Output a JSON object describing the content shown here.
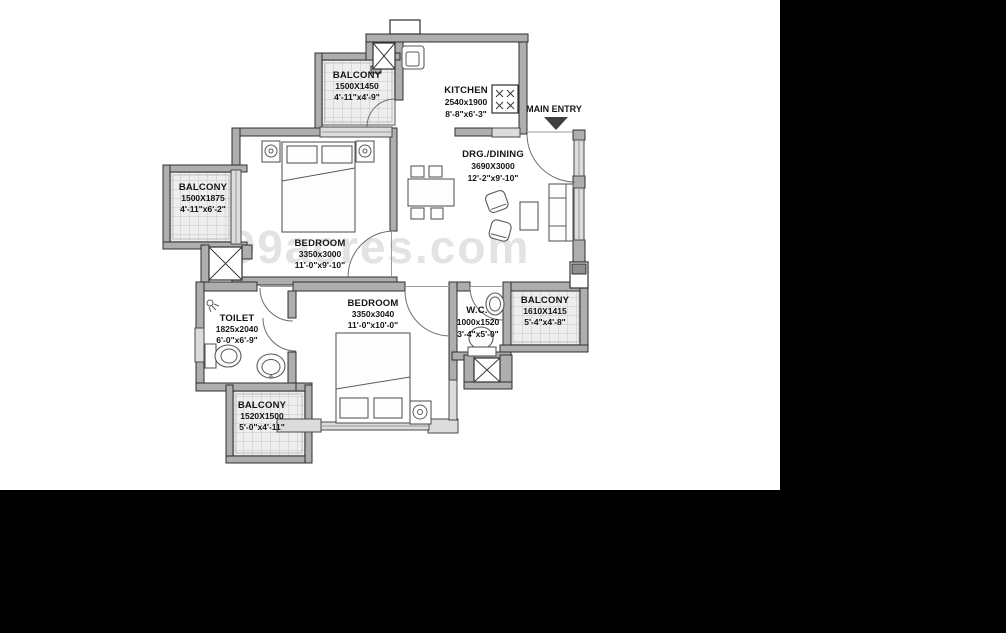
{
  "watermark": "99acres.com",
  "entry": {
    "label": "MAIN ENTRY"
  },
  "rooms": {
    "balcony_top": {
      "name": "BALCONY",
      "metric": "1500X1450",
      "imperial": "4'-11\"x4'-9\""
    },
    "kitchen": {
      "name": "KITCHEN",
      "metric": "2540x1900",
      "imperial": "8'-8\"x6'-3\""
    },
    "drg_dining": {
      "name": "DRG./DINING",
      "metric": "3690X3000",
      "imperial": "12'-2\"x9'-10\""
    },
    "balcony_left": {
      "name": "BALCONY",
      "metric": "1500X1875",
      "imperial": "4'-11\"x6'-2\""
    },
    "bedroom1": {
      "name": "BEDROOM",
      "metric": "3350x3000",
      "imperial": "11'-0\"x9'-10\""
    },
    "toilet": {
      "name": "TOILET",
      "metric": "1825x2040",
      "imperial": "6'-0\"x6'-9\""
    },
    "bedroom2": {
      "name": "BEDROOM",
      "metric": "3350x3040",
      "imperial": "11'-0\"x10'-0\""
    },
    "wc": {
      "name": "W.C.",
      "metric": "1000x1520",
      "imperial": "3'-4\"x5'-0\""
    },
    "balcony_right": {
      "name": "BALCONY",
      "metric": "1610X1415",
      "imperial": "5'-4\"x4'-8\""
    },
    "balcony_bottom": {
      "name": "BALCONY",
      "metric": "1520X1500",
      "imperial": "5'-0\"x4'-11\""
    }
  },
  "colors": {
    "background": "#000000",
    "paper": "#ffffff",
    "wall": "#aeaeae",
    "wall_outline": "#2f2f2f",
    "window": "#dcdcdc",
    "watermark": "#e3e3e3"
  }
}
